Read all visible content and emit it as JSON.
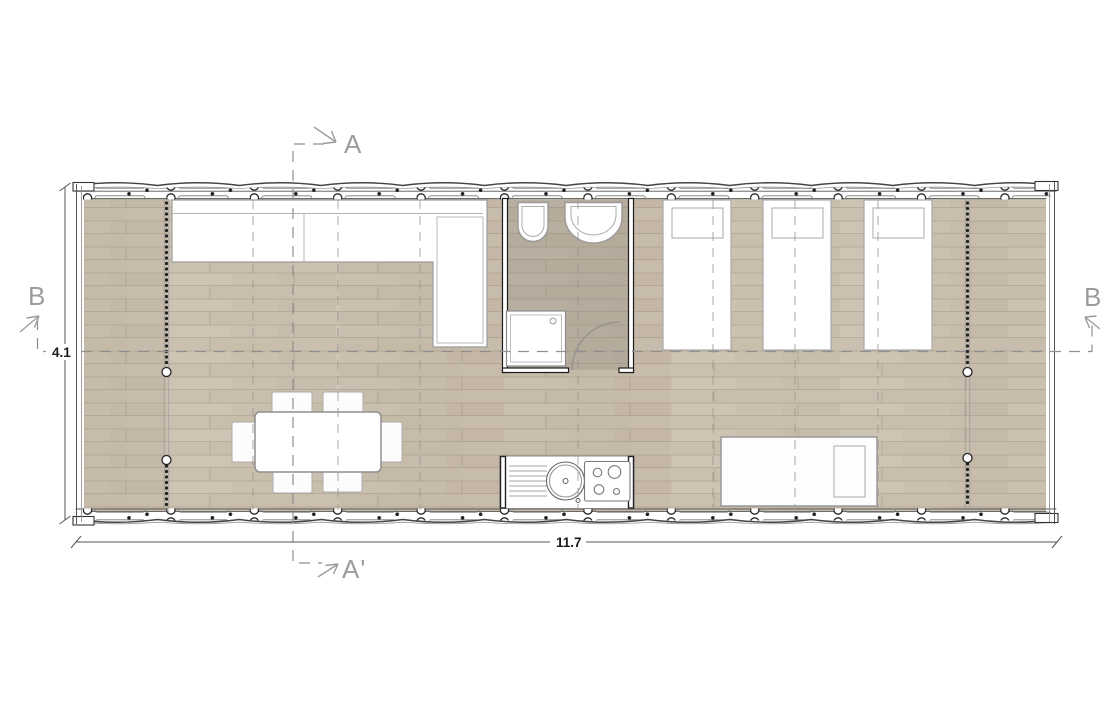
{
  "section_markers": {
    "top": "A",
    "bottom": "A'",
    "left": "B",
    "right": "B'"
  },
  "dimensions": {
    "length": "11.7",
    "width": "4.1"
  },
  "colors": {
    "floor": "#cbc0b0",
    "bathroom_floor": "#b2a89b",
    "wall_line": "#222222",
    "furniture_fill": "#ffffff",
    "furniture_line": "#9a9a9a",
    "dashed_line": "#9a958c",
    "label": "#9c9c9c",
    "dimension_text": "#1a1a1a"
  },
  "inventory": {
    "beds": 3,
    "dining_chairs": 6,
    "dining_tables": 1,
    "daybeds": 1,
    "showers": 1,
    "toilets": 1,
    "washbasins": 1,
    "kitchenettes": 1
  }
}
